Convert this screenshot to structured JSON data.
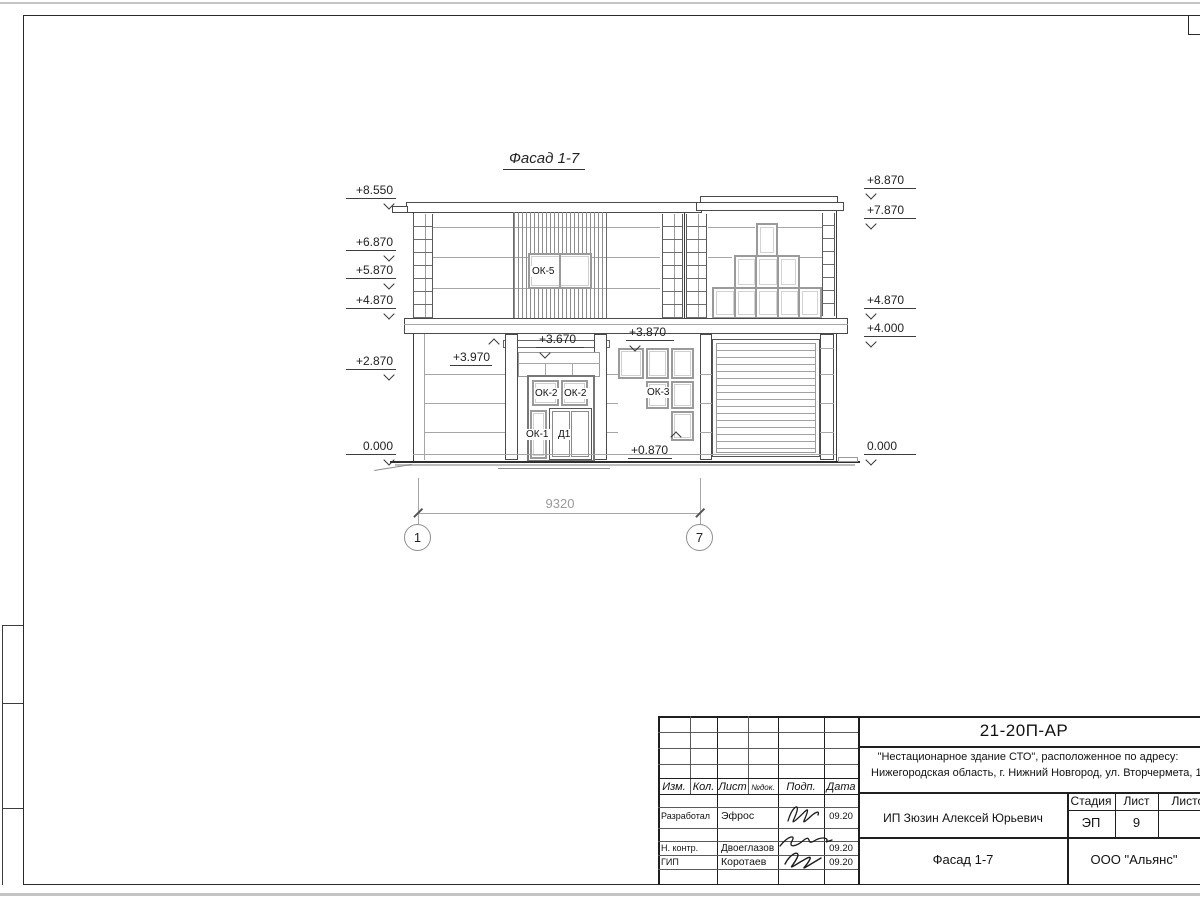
{
  "sheet": {
    "drawing_title": "Фасад 1-7",
    "dimension": "9320",
    "axes": [
      "1",
      "7"
    ],
    "elevation_marks": {
      "left": [
        "+8.550",
        "+6.870",
        "+5.870",
        "+4.870",
        "+2.870",
        "0.000"
      ],
      "right": [
        "+8.870",
        "+7.870",
        "+4.870",
        "+4.000",
        "0.000"
      ],
      "inner": [
        "+3.970",
        "+3.670",
        "+3.870",
        "+0.870"
      ]
    },
    "window_labels": {
      "ok5": "ОК-5",
      "ok2a": "ОК-2",
      "ok2b": "ОК-2",
      "ok1": "ОК-1",
      "d1": "Д1",
      "ok3": "ОК-3"
    }
  },
  "title_block": {
    "doc_number": "21-20П-АР",
    "project_line1": "\"Нестационарное здание СТО\", расположенное по адресу:",
    "project_line2": "Нижегородская область, г. Нижний Новгород, ул. Вторчермета, 1А",
    "columns": [
      "Изм.",
      "Кол.",
      "Лист",
      "№док.",
      "Подп.",
      "Дата"
    ],
    "rows": [
      {
        "role": "Разработал",
        "name": "Эфрос",
        "date": "09.20"
      },
      {
        "role": "Н. контр.",
        "name": "Двоеглазов",
        "date": "09.20"
      },
      {
        "role": "ГИП",
        "name": "Коротаев",
        "date": "09.20"
      }
    ],
    "client": "ИП Зюзин Алексей Юрьевич",
    "stage_label": "Стадия",
    "sheet_label": "Лист",
    "sheets_label": "Листов",
    "stage": "ЭП",
    "sheet_number": "9",
    "view_title": "Фасад 1-7",
    "company": "ООО \"Альянс\""
  }
}
